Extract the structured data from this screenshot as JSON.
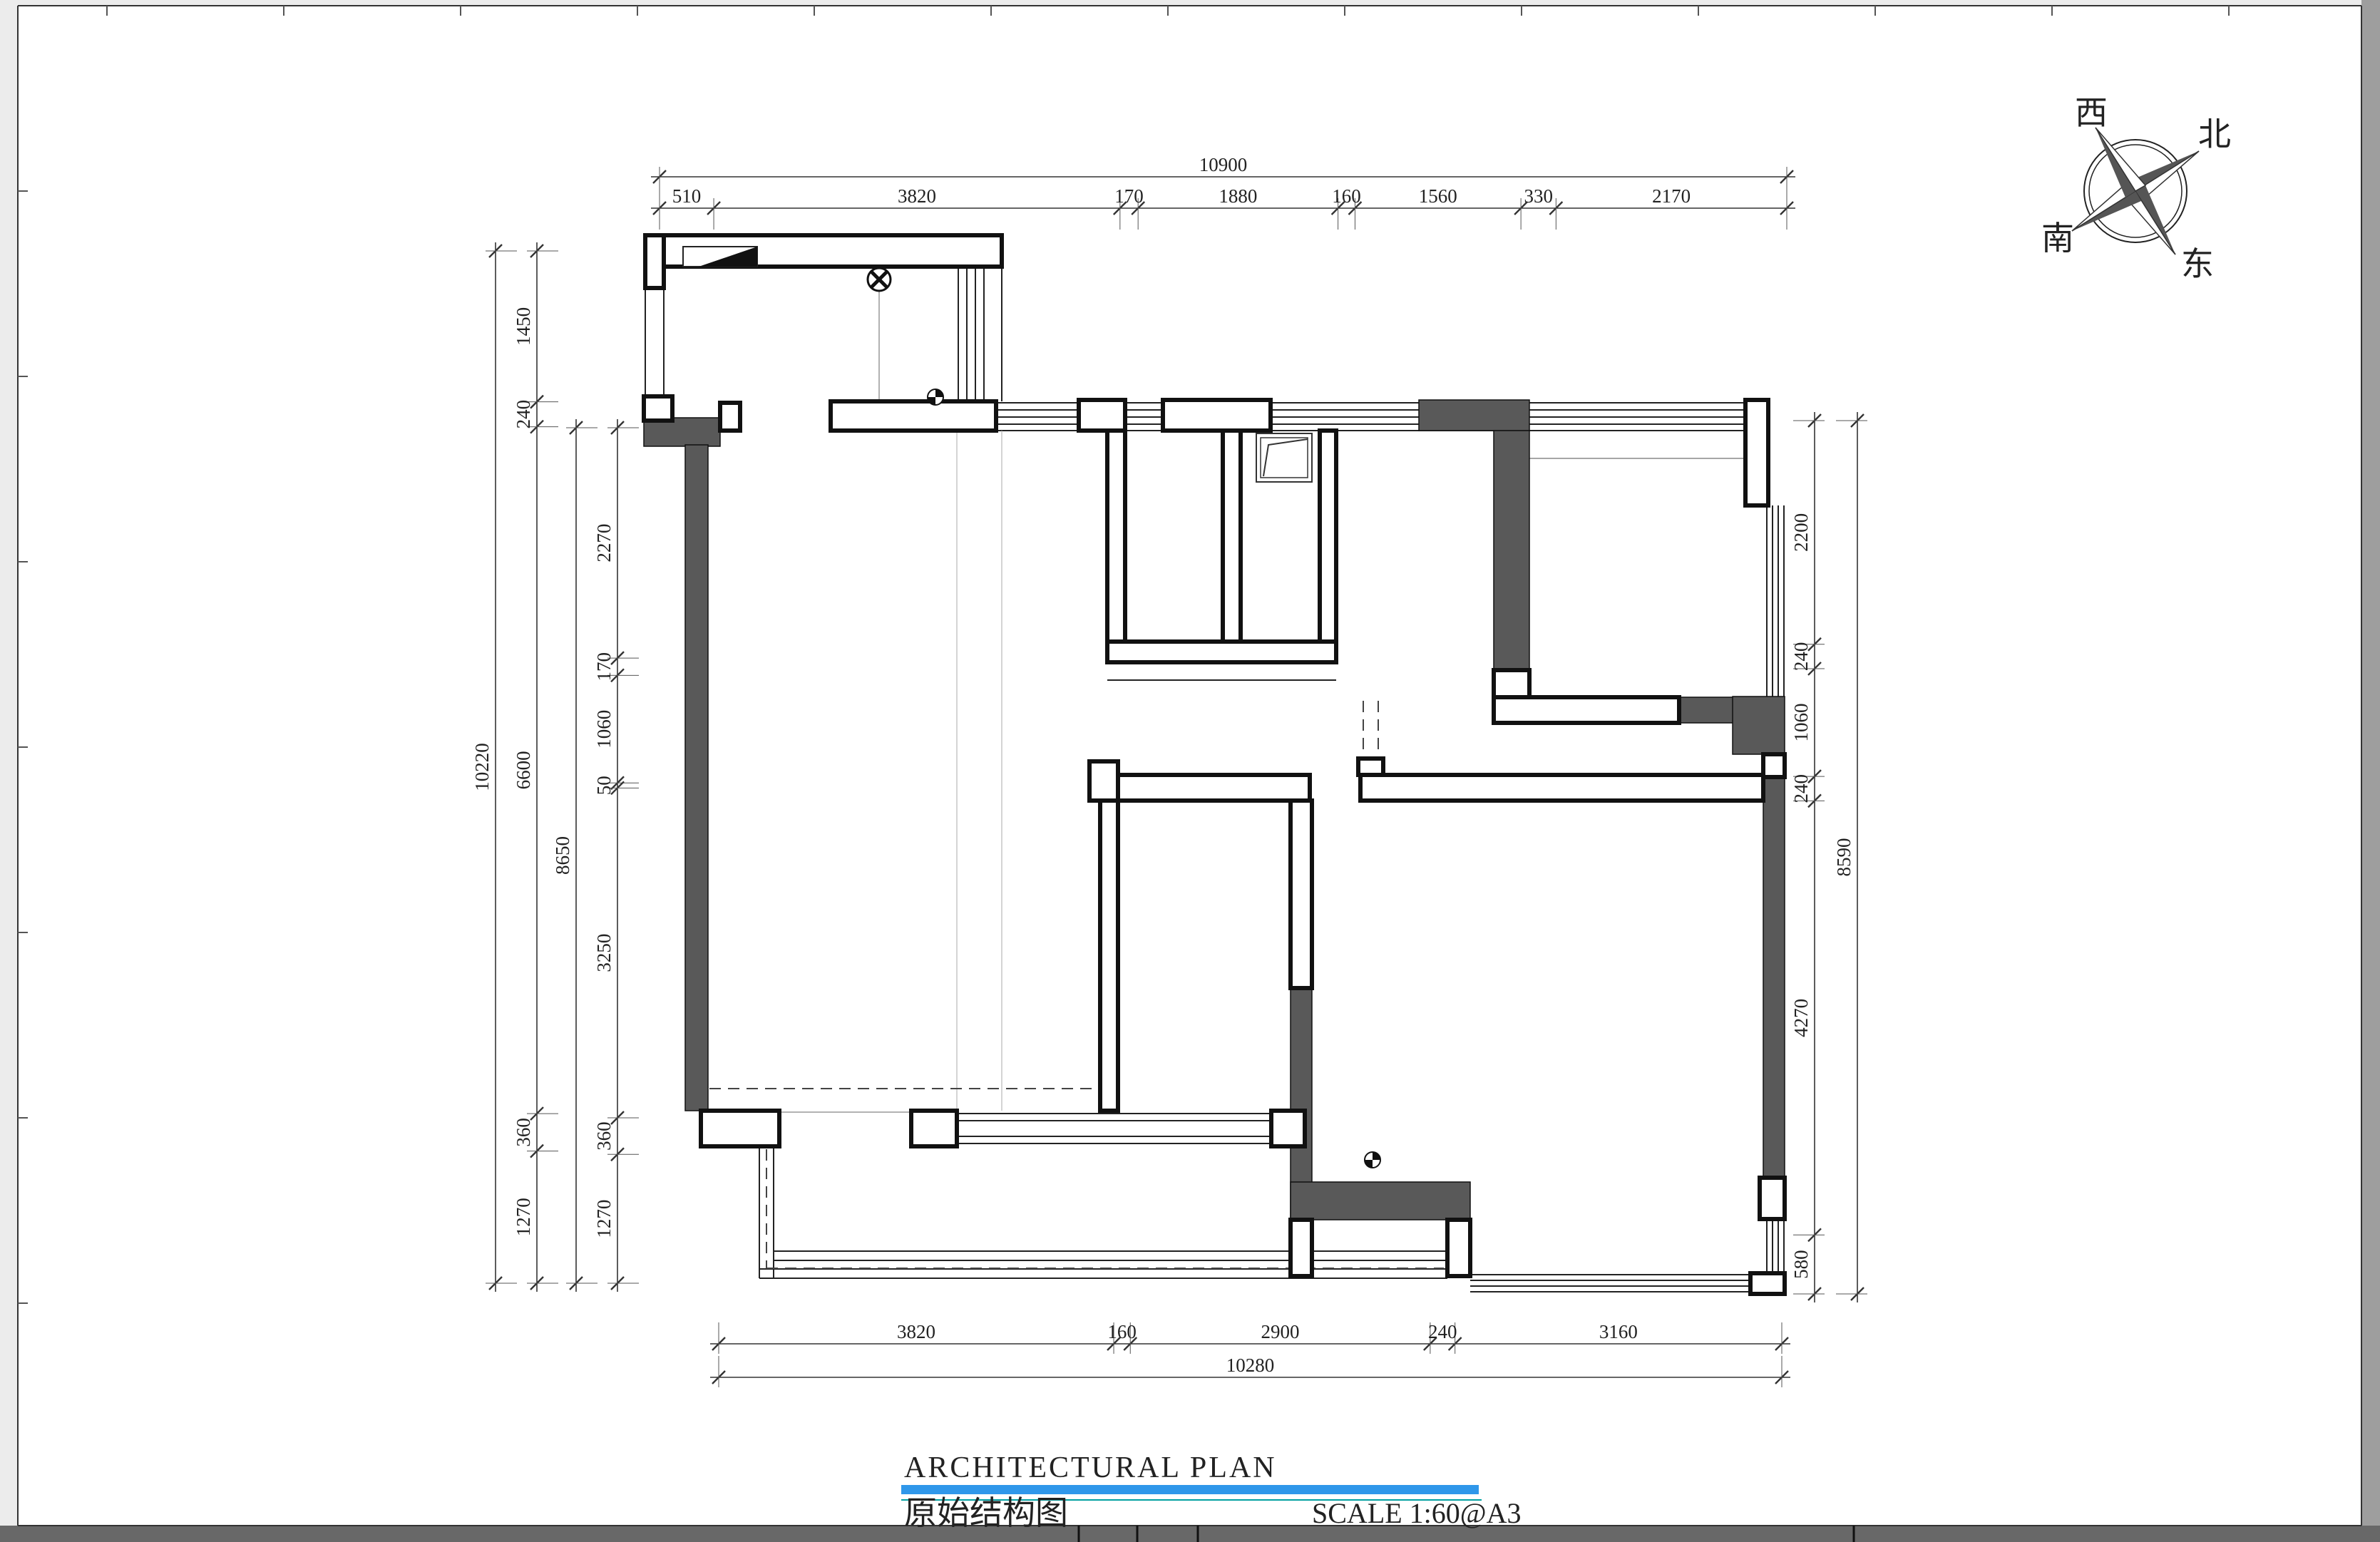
{
  "sheet": {
    "background": "#ffffff",
    "line_color": "#1a1a1a",
    "wall_fill_color": "#595959",
    "right_edge_bar_color": "#9e9e9e",
    "bottom_edge_bar_color": "#686868"
  },
  "title_block": {
    "title_en": "ARCHITECTURAL PLAN",
    "title_cn": "原始结构图",
    "scale_label": "SCALE  1:60@A3",
    "accent_bar_color": "#2f97ea",
    "thin_rule_color": "#00a0a0"
  },
  "compass": {
    "west_label": "西",
    "north_label": "北",
    "south_label": "南",
    "east_label": "东"
  },
  "dimensions": {
    "top_overall": "10900",
    "top_segments": [
      "510",
      "3820",
      "170",
      "1880",
      "160",
      "1560",
      "330",
      "2170"
    ],
    "left_overall": "10220",
    "left_outer_segments": [
      "1450",
      "240",
      "6600",
      "360",
      "1270"
    ],
    "left_inner_overall": "8650",
    "left_inner_segments": [
      "2270",
      "170",
      "1060",
      "50",
      "3250",
      "360",
      "1270"
    ],
    "right_overall": "8590",
    "right_segments": [
      "2200",
      "240",
      "1060",
      "240",
      "4270",
      "580"
    ],
    "bottom_overall": "10280",
    "bottom_segments": [
      "3820",
      "160",
      "2900",
      "240",
      "3160"
    ]
  },
  "symbols": {
    "drain": "circle-x-symbol",
    "marker": "quadrant-circle-symbol"
  }
}
